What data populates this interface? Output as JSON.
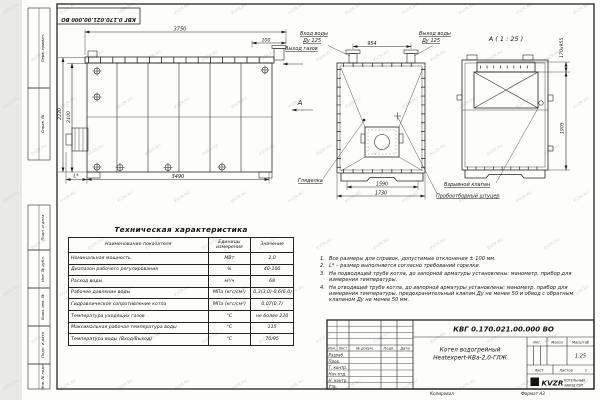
{
  "watermark": {
    "text": "KVZR.RU"
  },
  "colors": {
    "ink": "#222222",
    "paper": "#fdfdfc",
    "outside": "#e9e9e7",
    "watermark": "#d4d6d7"
  },
  "frame": {
    "doc_number_top": "КВГ 0.170.021.00.000 ВО",
    "margin_boxes": [
      "Перв. примен.",
      "Справ. №",
      "Подп. и дата",
      "Инв. № дубл.",
      "Взам. инв. №",
      "Подп. и дата",
      "Инв. № подл."
    ]
  },
  "side_view": {
    "dim_3750": "3750",
    "dim_100": "100",
    "dim_2230": "2230",
    "dim_2100": "2100",
    "dim_3490": "3490",
    "dim_l": "L*"
  },
  "front_view": {
    "label_water_in": "Вход воды",
    "label_water_in_dn": "Ду 125",
    "label_water_out": "Выход воды",
    "label_water_out_dn": "Ду 125",
    "label_gas_out": "Выход газов",
    "view_letter": "А",
    "dim_954": "954",
    "dim_1590": "1590",
    "dim_1730": "1730",
    "label_peephole": "Гляделка"
  },
  "rear_view": {
    "title": "А ( 1 : 25 )",
    "dim_duct": "170х955",
    "dim_1905": "1905",
    "label_explosion_valve": "Взрывной клапан",
    "label_sampling_fitting": "Пробоотборный штуцер"
  },
  "spec_table": {
    "title": "Техническая характеристика",
    "headers": [
      "Наименование показателя",
      "Единицы измерения",
      "Значение"
    ],
    "rows": [
      {
        "name": "Номинальная мощность",
        "unit": "МВт",
        "value": "2,0"
      },
      {
        "name": "Диапазон рабочего регулирования",
        "unit": "%",
        "value": "40-100"
      },
      {
        "name": "Расход воды",
        "unit": "м³/ч",
        "value": "68"
      },
      {
        "name": "Рабочее давление воды",
        "unit": "МПа (кгс/см²)",
        "value": "0,3(3,0)-0,6(6,0)"
      },
      {
        "name": "Гидравлическое сопротивление котла",
        "unit": "МПа (кгс/см²)",
        "value": "0,07(0,7)"
      },
      {
        "name": "Температура уходящих газов",
        "unit": "°С",
        "value": "не более 220"
      },
      {
        "name": "Максимальная рабочая температура воды",
        "unit": "°С",
        "value": "115"
      },
      {
        "name": "Температура воды (Вход/Выход)",
        "unit": "°С",
        "value": "70/95"
      }
    ]
  },
  "notes": [
    {
      "num": "1.",
      "text": "Все размеры для справок, допустимые отклонения ± 100 мм."
    },
    {
      "num": "2.",
      "text": "L* – размер выполняется согласно требований горелки."
    },
    {
      "num": "3.",
      "text": "На подводящей трубе котла, до запорной арматуры установлены: манометр, прибор для измерения температуры."
    },
    {
      "num": "4.",
      "text": "На отводящей трубе котла, до запорной арматуры установлены: манометр, прибор для измерения температуры, предохранительный клапан Ду не менее 50 и обвод с обратным клапаном Ду не менее 50 мм."
    }
  ],
  "title_block": {
    "doc_number": "КВГ 0.170.021.00.000 ВО",
    "product_name_1": "Котел водогрейный",
    "product_name_2": "Heatexpert-КВа-2,0-ГЛЖ",
    "col_izm": "Изм.",
    "col_list": "Лист",
    "col_doc": "№ докум.",
    "col_podp": "Подп.",
    "col_data": "Дата",
    "roles": [
      "Разраб.",
      "Пров.",
      "Т. контр.",
      "Нач.отд.",
      "Н. контр.",
      "Утв."
    ],
    "lit_label": "Лит.",
    "mass_label": "Масса",
    "scale_label": "Масштаб",
    "scale_value": "1:25",
    "sheet_label": "Лист",
    "sheets_label": "Листов",
    "sheets_value": "1",
    "logo_text": "KVZR",
    "logo_caption_1": "КОТЕЛЬНЫЙ",
    "logo_caption_2": "ЗАВОД РЭП",
    "copied": "Копировал",
    "format": "Формат А3"
  }
}
